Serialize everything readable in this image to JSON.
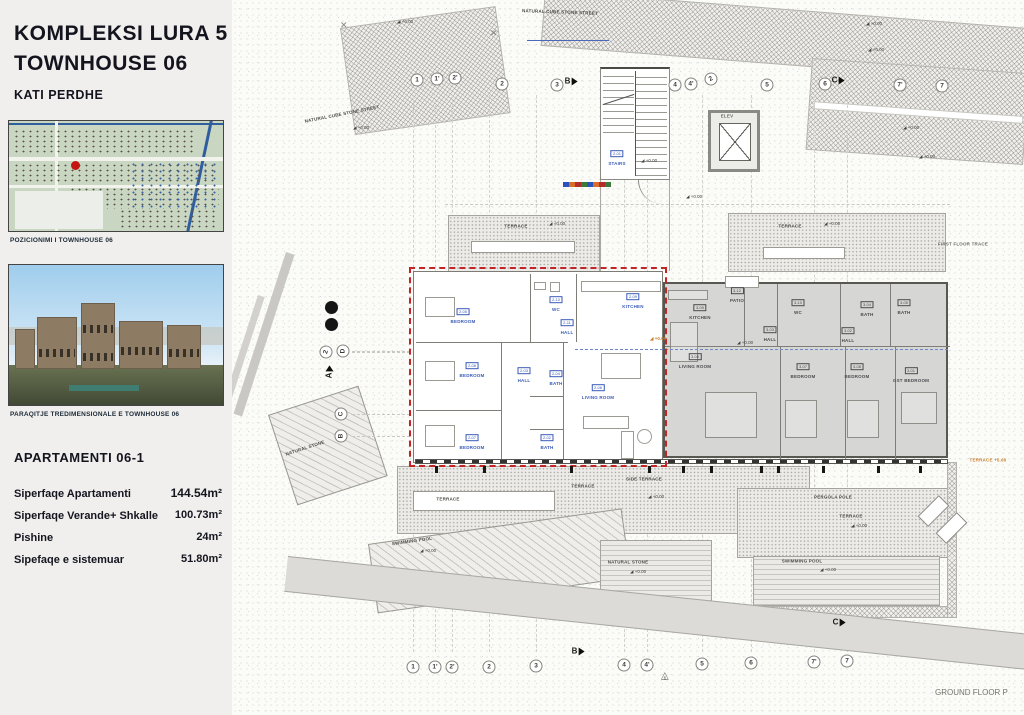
{
  "sidebar": {
    "title_line1": "KOMPLEKSI  LURA 5",
    "title_line2": "TOWNHOUSE 06",
    "subtitle": "KATI  PERDHE",
    "map_caption": "POZICIONIMI I TOWNHOUSE 06",
    "render_caption": "PARAQITJE TREDIMENSIONALE E TOWNHOUSE  06",
    "apartment_heading": "APARTAMENTI  06-1",
    "stats": [
      {
        "label": "Siperfaqe Apartamenti",
        "value": "144.54m²"
      },
      {
        "label": "Siperfaqe Verande+ Shkalle",
        "value": "100.73m²"
      },
      {
        "label": "Pishine",
        "value": "24m²"
      },
      {
        "label": "Sipefaqe e sistemuar",
        "value": "51.80m²"
      }
    ]
  },
  "plan": {
    "footer_label": "GROUND FLOOR P",
    "elevation_text": "+0.00",
    "stairs": {
      "num": "2-01",
      "name": "STAIRS",
      "x": 617,
      "y": 154
    },
    "grid_top": [
      {
        "label": "1",
        "x": 417,
        "y": 80
      },
      {
        "label": "1'",
        "x": 437,
        "y": 79
      },
      {
        "label": "2'",
        "x": 455,
        "y": 78
      },
      {
        "label": "2",
        "x": 502,
        "y": 84
      },
      {
        "label": "3",
        "x": 557,
        "y": 85
      },
      {
        "label": "4",
        "x": 675,
        "y": 85
      },
      {
        "label": "4'",
        "x": 691,
        "y": 84
      },
      {
        "label": "2",
        "x": 711,
        "y": 79,
        "rot": -30
      },
      {
        "label": "5",
        "x": 767,
        "y": 85
      },
      {
        "label": "6",
        "x": 825,
        "y": 84
      },
      {
        "label": "7'",
        "x": 900,
        "y": 85
      },
      {
        "label": "7",
        "x": 942,
        "y": 86
      }
    ],
    "grid_bottom": [
      {
        "label": "1",
        "x": 413,
        "y": 667
      },
      {
        "label": "1'",
        "x": 435,
        "y": 667
      },
      {
        "label": "2'",
        "x": 452,
        "y": 667
      },
      {
        "label": "2",
        "x": 489,
        "y": 667
      },
      {
        "label": "3",
        "x": 536,
        "y": 666
      },
      {
        "label": "4",
        "x": 624,
        "y": 665
      },
      {
        "label": "4'",
        "x": 647,
        "y": 665
      },
      {
        "label": "5",
        "x": 702,
        "y": 664
      },
      {
        "label": "6",
        "x": 751,
        "y": 663
      },
      {
        "label": "7'",
        "x": 814,
        "y": 662
      },
      {
        "label": "7",
        "x": 847,
        "y": 661
      }
    ],
    "grid_side": [
      {
        "label": "2",
        "x": 326,
        "y": 352,
        "rot": -75
      },
      {
        "label": "D",
        "x": 343,
        "y": 351,
        "rot": -90
      },
      {
        "label": "C",
        "x": 341,
        "y": 414,
        "rot": -90
      },
      {
        "label": "B",
        "x": 341,
        "y": 436,
        "rot": -90
      }
    ],
    "section_markers": [
      {
        "label": "B",
        "x": 571,
        "y": 81
      },
      {
        "label": "C",
        "x": 838,
        "y": 80
      },
      {
        "label": "B",
        "x": 578,
        "y": 651
      },
      {
        "label": "C",
        "x": 839,
        "y": 622
      },
      {
        "label": "A",
        "x": 329,
        "y": 372,
        "rot": -90
      }
    ],
    "triangle_marker": {
      "label": "1",
      "x": 665,
      "y": 676
    },
    "rooms_unit1": [
      {
        "num": "2-05",
        "name": "BEDROOM",
        "x": 463,
        "y": 312
      },
      {
        "num": "2-10",
        "name": "WC",
        "x": 556,
        "y": 300
      },
      {
        "num": "2-09",
        "name": "KITCHEN",
        "x": 633,
        "y": 297
      },
      {
        "num": "2-11",
        "name": "HALL",
        "x": 567,
        "y": 323
      },
      {
        "num": "2-08",
        "name": "BEDROOM",
        "x": 472,
        "y": 366
      },
      {
        "num": "2-03",
        "name": "HALL",
        "x": 524,
        "y": 371
      },
      {
        "num": "2-04",
        "name": "BATH",
        "x": 556,
        "y": 374
      },
      {
        "num": "2-06",
        "name": "LIVING ROOM",
        "x": 598,
        "y": 388
      },
      {
        "num": "2-07",
        "name": "BEDROOM",
        "x": 472,
        "y": 438
      },
      {
        "num": "2-02",
        "name": "BATH",
        "x": 547,
        "y": 438
      }
    ],
    "rooms_unit2": [
      {
        "num": "3-09",
        "name": "KITCHEN",
        "x": 700,
        "y": 308
      },
      {
        "num": "3-12",
        "name": "PATIO",
        "x": 737,
        "y": 291
      },
      {
        "num": "3-10",
        "name": "WC",
        "x": 798,
        "y": 303
      },
      {
        "num": "3-04",
        "name": "BATH",
        "x": 867,
        "y": 305
      },
      {
        "num": "3-05",
        "name": "BATH",
        "x": 904,
        "y": 303
      },
      {
        "num": "3-03",
        "name": "HALL",
        "x": 770,
        "y": 330
      },
      {
        "num": "3-02",
        "name": "HALL",
        "x": 848,
        "y": 331
      },
      {
        "num": "3-06",
        "name": "LIVING ROOM",
        "x": 695,
        "y": 357
      },
      {
        "num": "3-07",
        "name": "BEDROOM",
        "x": 803,
        "y": 367
      },
      {
        "num": "3-08",
        "name": "BEDROOM",
        "x": 857,
        "y": 367
      },
      {
        "num": "3-01",
        "name": "GST BEDROOM",
        "x": 911,
        "y": 371
      }
    ],
    "annotations": [
      {
        "text": "NATURAL CUBE STONE STREET",
        "x": 342,
        "y": 114,
        "rot": -11
      },
      {
        "text": "NATURAL CUBE STONE STREET",
        "x": 560,
        "y": 12,
        "rot": 2
      },
      {
        "text": "FIRST FLOOR TRACE",
        "x": 963,
        "y": 244,
        "color": "#6b6b66"
      },
      {
        "text": "TERRACE",
        "x": 516,
        "y": 226
      },
      {
        "text": "TERRACE",
        "x": 790,
        "y": 226
      },
      {
        "text": "TERRACE",
        "x": 448,
        "y": 499
      },
      {
        "text": "TERRACE",
        "x": 583,
        "y": 486
      },
      {
        "text": "SIDE TERRACE",
        "x": 644,
        "y": 479
      },
      {
        "text": "SWIMMING POOL",
        "x": 412,
        "y": 541,
        "rot": -8
      },
      {
        "text": "NATURAL STONE",
        "x": 628,
        "y": 562
      },
      {
        "text": "NATURAL STONE",
        "x": 305,
        "y": 448,
        "rot": -18
      },
      {
        "text": "PERGOLA POLE",
        "x": 833,
        "y": 497
      },
      {
        "text": "TERRACE",
        "x": 851,
        "y": 516
      },
      {
        "text": "SWIMMING POOL",
        "x": 802,
        "y": 561
      },
      {
        "text": "TERRACE +5.60",
        "x": 988,
        "y": 460,
        "color": "#c87f2a"
      },
      {
        "text": "ELEV",
        "x": 727,
        "y": 116,
        "color": "#666662"
      }
    ],
    "elevations": [
      {
        "x": 397,
        "y": 22
      },
      {
        "x": 866,
        "y": 24
      },
      {
        "x": 868,
        "y": 50
      },
      {
        "x": 353,
        "y": 128
      },
      {
        "x": 903,
        "y": 128
      },
      {
        "x": 919,
        "y": 157
      },
      {
        "x": 549,
        "y": 224
      },
      {
        "x": 824,
        "y": 224
      },
      {
        "x": 686,
        "y": 197
      },
      {
        "x": 641,
        "y": 161
      },
      {
        "x": 650,
        "y": 339,
        "hl": true
      },
      {
        "x": 737,
        "y": 343
      },
      {
        "x": 648,
        "y": 497
      },
      {
        "x": 420,
        "y": 551
      },
      {
        "x": 630,
        "y": 572
      },
      {
        "x": 820,
        "y": 570
      },
      {
        "x": 851,
        "y": 526
      }
    ],
    "ticks": {
      "y": 466,
      "xs": [
        435,
        483,
        570,
        648,
        682,
        710,
        760,
        777,
        822,
        877,
        919
      ]
    }
  },
  "colors": {
    "accent_red": "#c12525",
    "label_blue": "#3a5bb8",
    "unit2_fill": "#d6d6d4",
    "elevation_highlight": "#c87f2a"
  }
}
